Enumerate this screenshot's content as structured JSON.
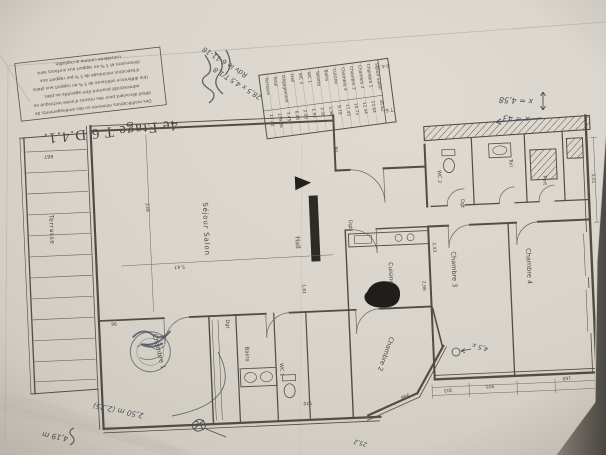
{
  "photo": {
    "paper_hex": "#d8d4cb",
    "backdrop_hex": "#55514b",
    "ink_hex": "#514d46",
    "pen_hex": "#47505a"
  },
  "title": {
    "text": "4e Etage T 6 D.4.1."
  },
  "disclaimer": {
    "lines": [
      "Des modifications mineures ou des aménagements de",
      "détail découlant pour des raisons d'ordre technique ou",
      "administratif pourront être apportés au plan.",
      "Une différence inférieure de 5 % en rapport aux plans",
      "d'exécution minimisée de 5 % par rapport aux",
      "dimensions et 5 % en rapport aux surfaces sera",
      "considérée comme acceptable."
    ]
  },
  "area_table": {
    "header": {
      "unit_label": "D.4.1",
      "type_label": "T 6"
    },
    "columns": [
      {
        "label": "Terrasse",
        "value": "13.40"
      },
      {
        "label": "Total",
        "value": "139.36"
      },
      {
        "label": "Dégagement",
        "value": "3.45"
      },
      {
        "label": "Hall",
        "value": "6.45"
      },
      {
        "label": "WC 2",
        "value": "2.03"
      },
      {
        "label": "WC 1",
        "value": "1.92"
      },
      {
        "label": "Toilette",
        "value": "2.56"
      },
      {
        "label": "Bains",
        "value": "3.98"
      },
      {
        "label": "Cuisine",
        "value": "9.79"
      },
      {
        "label": "Chambre 4",
        "value": "11.45"
      },
      {
        "label": "Chambre 3",
        "value": "10.73"
      },
      {
        "label": "Chambre 2",
        "value": "12.34"
      },
      {
        "label": "Chambre 1",
        "value": "13.64"
      },
      {
        "label": "Séjour Salon",
        "value": "36.62"
      }
    ]
  },
  "room_labels": {
    "sejour": "Séjour  Salon",
    "terrasse": "Terrasse",
    "hall": "Hall",
    "cuisine": "Cuisine",
    "chambre1": "Chambre 1",
    "chambre2": "Chambre 2",
    "chambre3": "Chambre 3",
    "chambre4": "Chambre 4",
    "bains": "Bains",
    "wc1": "WC 1",
    "wc2": "WC 2",
    "toil": "Toil",
    "port": "Port",
    "dgt1": "Dgt",
    "dgt2": "Dgt",
    "dgt3": "Dgt"
  },
  "dimensions": {
    "d1": "667",
    "d2": "239",
    "d3": "5,47",
    "d4": "1,81",
    "d5": "90",
    "d6": "348",
    "d7": "303",
    "d8": "955",
    "d9": "160",
    "d10": "2,03",
    "d11": "3,01",
    "d12": "96",
    "d13": "520",
    "d14": "2,96"
  },
  "annotations": {
    "x_note_1": "x = 4,58",
    "x_note_2": "x = 43",
    "date_note": "Rdv le 6-11-18",
    "calc_note": "28,5 x 4,5 T/1,8",
    "measure_note_1": "2,50 m (2,35)",
    "measure_note_2": "4,19 m",
    "chambre2_note": "4,5 x",
    "edge_note_1": "25,2",
    "edge_note_2": "25,3"
  }
}
